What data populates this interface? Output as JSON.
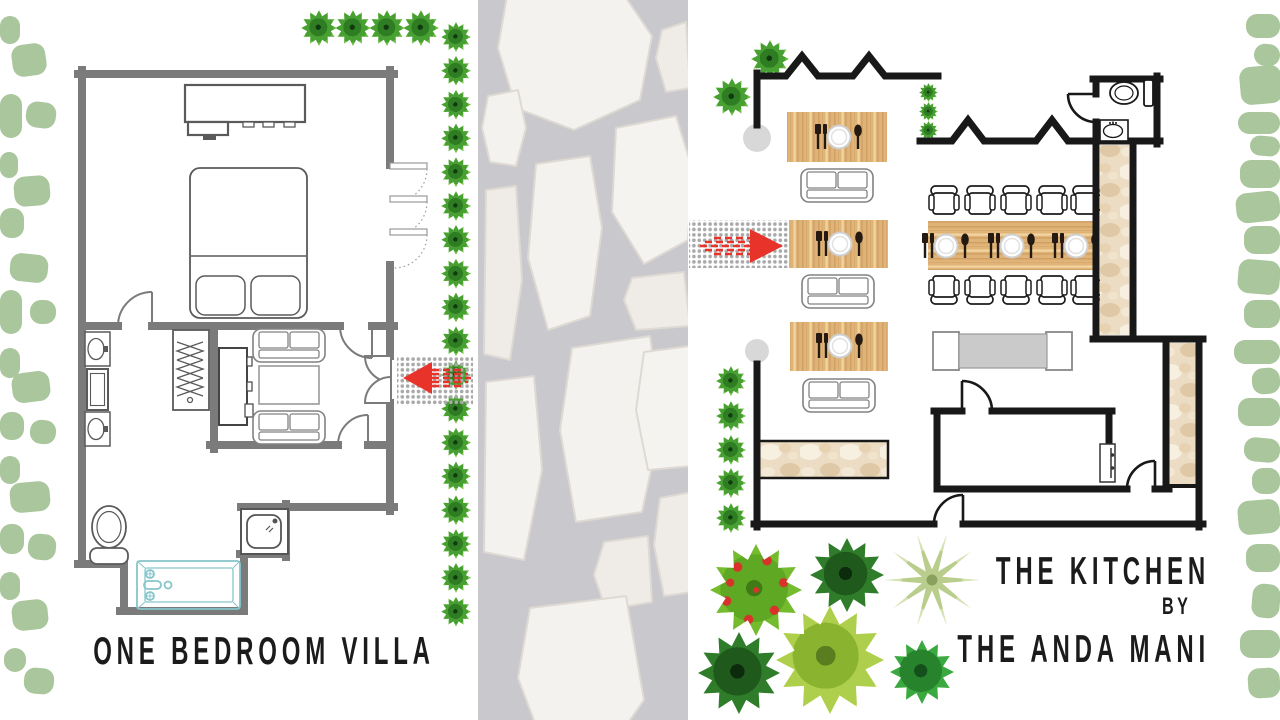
{
  "page": {
    "description": "Resort site plan poster with two floor plans separated by a stone garden path"
  },
  "labels": {
    "villa_title": "ONE BEDROOM VILLA",
    "kitchen_title_line1": "THE KITCHEN",
    "kitchen_title_line2": "BY",
    "kitchen_title_line3": "THE ANDA MANI"
  },
  "colors": {
    "wall_gray": "#7b7b7b",
    "wall_black": "#181818",
    "accent_red": "#e8332b",
    "foliage_sage": "#a9c69c",
    "wood": "#e0b478",
    "marble": "#ecdcc3",
    "path_gray": "#c9c9cd",
    "stone": "#f4f2ee",
    "tub_blue": "#86c5cb",
    "title_ink": "#1b1b1b"
  },
  "villa": {
    "furniture": [
      "dresser",
      "king-bed",
      "pillows",
      "wardrobe-with-hangers",
      "tv-console",
      "sofa",
      "coffee-table",
      "sofa",
      "sink-vanity",
      "mirror",
      "sink-vanity",
      "toilet",
      "bathtub",
      "shower",
      "louvre-windows",
      "entrance-double-door",
      "entrance-mat",
      "entrance-arrow"
    ]
  },
  "kitchen": {
    "furniture": [
      "dining-table",
      "bench-sofa",
      "dining-table",
      "bench-sofa",
      "dining-table",
      "bench-sofa",
      "communal-table",
      "dining-chairs",
      "prep-table",
      "marble-counter",
      "marble-corridor",
      "store-room",
      "wc-toilet",
      "wc-sink",
      "entrance-mat",
      "entrance-arrow",
      "planter",
      "planter"
    ]
  },
  "decor": {
    "left_blobs": [
      [
        0,
        16,
        20,
        28,
        0
      ],
      [
        12,
        44,
        34,
        32,
        -8
      ],
      [
        0,
        94,
        22,
        44,
        0
      ],
      [
        26,
        102,
        30,
        26,
        8
      ],
      [
        0,
        152,
        18,
        26,
        0
      ],
      [
        14,
        176,
        36,
        30,
        -5
      ],
      [
        0,
        208,
        24,
        30,
        0
      ],
      [
        10,
        254,
        38,
        28,
        6
      ],
      [
        0,
        290,
        22,
        44,
        0
      ],
      [
        30,
        300,
        26,
        24,
        0
      ],
      [
        0,
        348,
        20,
        30,
        0
      ],
      [
        12,
        372,
        38,
        30,
        -7
      ],
      [
        0,
        412,
        24,
        28,
        0
      ],
      [
        30,
        420,
        26,
        24,
        5
      ],
      [
        0,
        456,
        20,
        28,
        0
      ],
      [
        10,
        482,
        40,
        30,
        -5
      ],
      [
        0,
        524,
        24,
        30,
        0
      ],
      [
        28,
        534,
        28,
        26,
        6
      ],
      [
        0,
        572,
        20,
        28,
        0
      ],
      [
        12,
        600,
        36,
        30,
        -6
      ],
      [
        4,
        648,
        22,
        24,
        0
      ],
      [
        24,
        668,
        30,
        26,
        5
      ]
    ],
    "right_blobs": [
      [
        1246,
        14,
        34,
        24,
        0
      ],
      [
        1254,
        44,
        26,
        22,
        6
      ],
      [
        1240,
        66,
        42,
        38,
        -5
      ],
      [
        1238,
        112,
        42,
        22,
        0
      ],
      [
        1250,
        136,
        30,
        20,
        5
      ],
      [
        1240,
        160,
        40,
        28,
        0
      ],
      [
        1236,
        192,
        44,
        30,
        -6
      ],
      [
        1244,
        226,
        36,
        28,
        0
      ],
      [
        1238,
        260,
        42,
        34,
        5
      ],
      [
        1244,
        300,
        36,
        28,
        0
      ],
      [
        1234,
        340,
        46,
        24,
        0
      ],
      [
        1252,
        368,
        28,
        26,
        -5
      ],
      [
        1238,
        398,
        42,
        28,
        0
      ],
      [
        1244,
        438,
        36,
        24,
        5
      ],
      [
        1252,
        468,
        28,
        26,
        0
      ],
      [
        1238,
        500,
        42,
        34,
        -5
      ],
      [
        1246,
        544,
        34,
        28,
        0
      ],
      [
        1252,
        584,
        28,
        34,
        5
      ],
      [
        1240,
        630,
        40,
        28,
        0
      ],
      [
        1248,
        668,
        32,
        30,
        -4
      ]
    ],
    "path_trees": {
      "x": 441,
      "y_start": 22,
      "step": 33.8,
      "count": 18,
      "size": 30
    },
    "top_trees": [
      [
        301,
        10,
        36
      ],
      [
        335,
        10,
        36
      ],
      [
        369,
        10,
        36
      ],
      [
        403,
        10,
        36
      ]
    ],
    "kitchen_trees": [
      [
        751,
        40,
        38
      ],
      [
        713,
        78,
        38
      ],
      [
        919,
        83,
        19
      ],
      [
        919,
        102,
        19
      ],
      [
        919,
        121,
        19
      ],
      [
        716,
        366,
        30
      ],
      [
        716,
        401,
        30
      ],
      [
        716,
        435,
        30
      ],
      [
        716,
        468,
        30
      ],
      [
        716,
        503,
        30
      ]
    ],
    "big_trees": [
      [
        710,
        544,
        92,
        "berry"
      ],
      [
        810,
        538,
        74,
        "dark"
      ],
      [
        884,
        532,
        96,
        "palm"
      ],
      [
        698,
        632,
        82,
        "dark"
      ],
      [
        776,
        606,
        108,
        "light"
      ],
      [
        890,
        640,
        64,
        "mid"
      ]
    ]
  }
}
